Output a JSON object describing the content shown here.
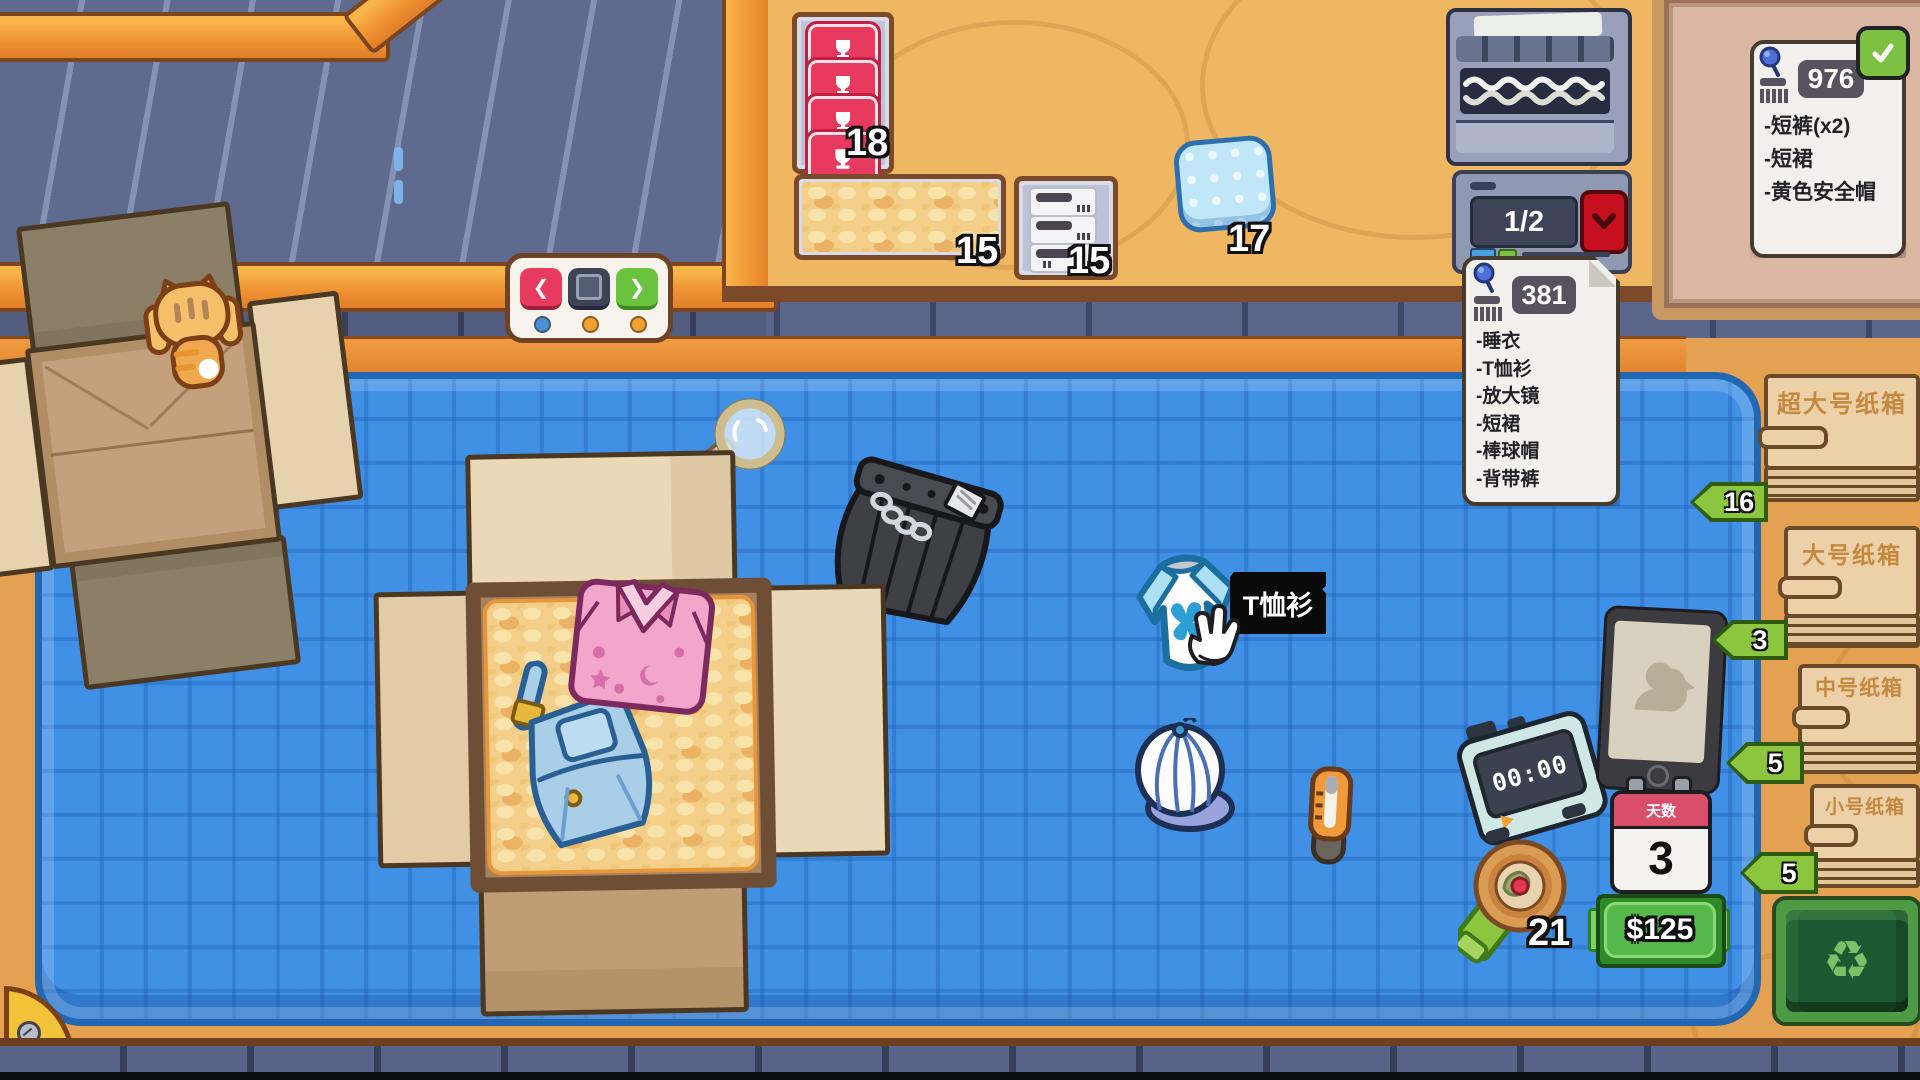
{
  "counters": {
    "stickers": "18",
    "peanuts": "15",
    "labels": "15",
    "bubble_wrap": "17",
    "tape": "21",
    "box_counter": "1/2"
  },
  "notes": {
    "active": {
      "id": "381",
      "items": [
        "-睡衣",
        "-T恤衫",
        "-放大镜",
        "-短裙",
        "-棒球帽",
        "-背带裤"
      ]
    },
    "done": {
      "id": "976",
      "items": [
        "-短裤(x2)",
        "-短裙",
        "-黄色安全帽"
      ]
    }
  },
  "tooltip": {
    "label": "T恤衫"
  },
  "hud": {
    "timer": "00:00",
    "calendar_label": "天数",
    "calendar_value": "3",
    "money": "$125"
  },
  "stacks": [
    {
      "label": "超大号纸箱",
      "count": "16"
    },
    {
      "label": "大号纸箱",
      "count": "3"
    },
    {
      "label": "中号纸箱",
      "count": "5"
    },
    {
      "label": "小号纸箱",
      "count": "5"
    }
  ],
  "nav": {
    "prev": "❮",
    "next": "❯"
  },
  "icons": {
    "recycle": "♻"
  },
  "colors": {
    "accent_green": "#8cc63e",
    "mat_blue": "#3f8fe6",
    "alert_red": "#c60f1f"
  }
}
